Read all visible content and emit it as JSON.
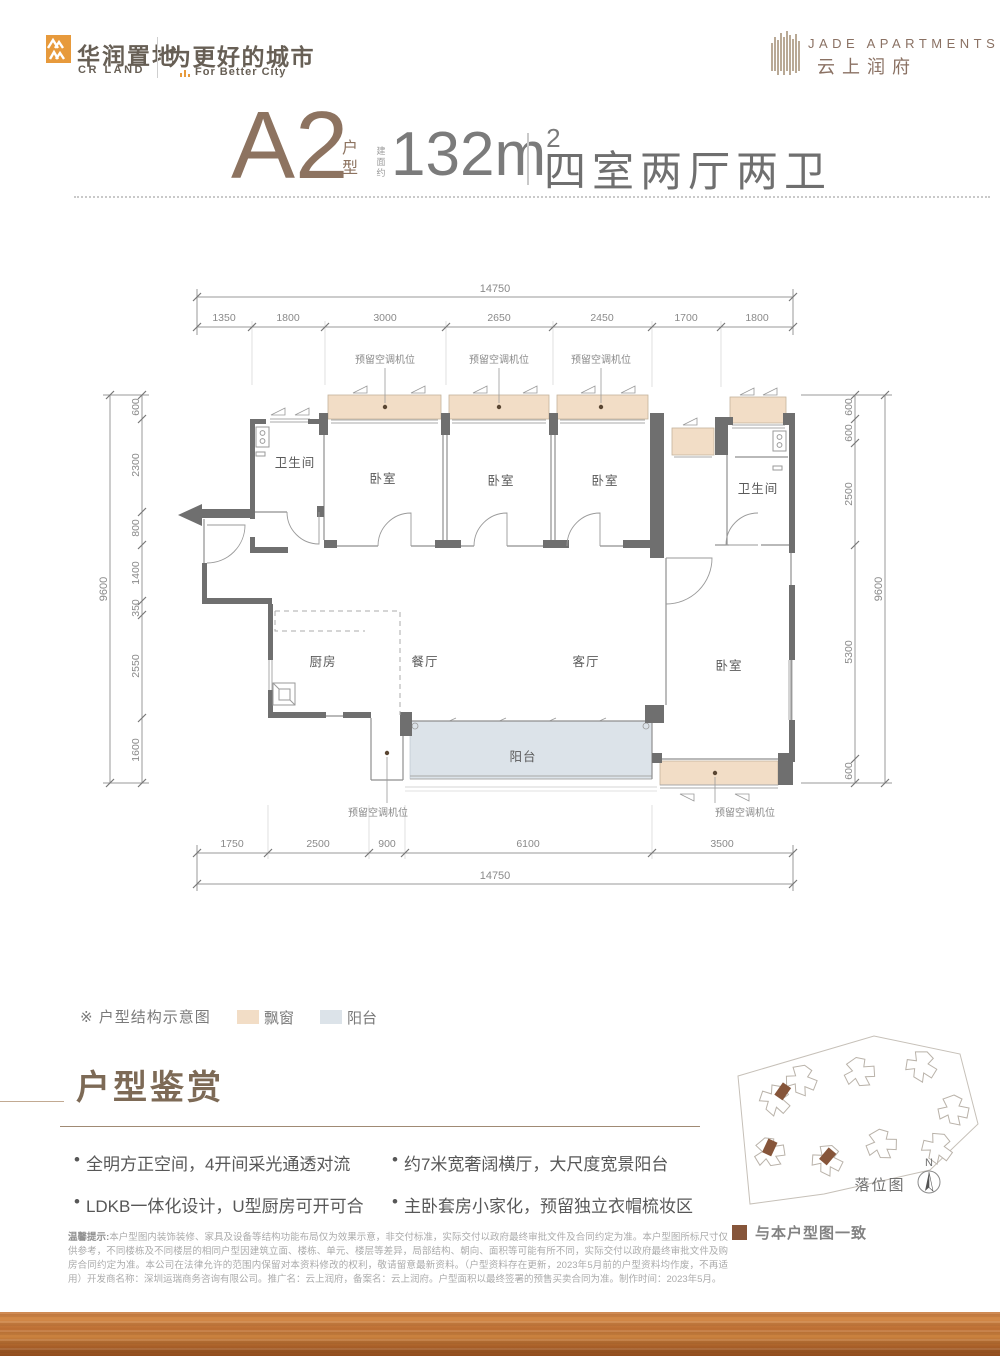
{
  "header": {
    "brand_cn": "华润置地",
    "brand_en": "CR LAND",
    "slogan_cn": "为更好的城市",
    "slogan_en": "For Better City",
    "project_en": "JADE APARTMENTS",
    "project_cn": "云上润府",
    "brand_orange": "#e79a3c",
    "brand_brown": "#8a7163"
  },
  "title": {
    "unit": "A2",
    "unit_suffix": "户型",
    "area_note": "建面约",
    "area": "132m",
    "area_sup": "2",
    "rooms": "四室两厅两卫"
  },
  "plan": {
    "rooms": {
      "bath": "卫生间",
      "bedroom": "卧室",
      "kitchen": "厨房",
      "dining": "餐厅",
      "living": "客厅",
      "balcony": "阳台"
    },
    "ac": "预留空调机位",
    "dims": {
      "top_total": "14750",
      "top": [
        "1350",
        "1800",
        "3000",
        "2650",
        "2450",
        "1700",
        "1800"
      ],
      "bottom": [
        "1750",
        "2500",
        "900",
        "6100",
        "3500"
      ],
      "bottom_total": "14750",
      "left": [
        "600",
        "2300",
        "800",
        "1400",
        "350",
        "2550",
        "1600"
      ],
      "left_total": "9600",
      "right": [
        "600",
        "600",
        "2500",
        "5300",
        "600"
      ],
      "right_total": "9600"
    },
    "colors": {
      "bay_window": "#f2ddc6",
      "balcony": "#dce3e9",
      "wall": "#6f6f6f"
    }
  },
  "legend": {
    "note": "※ 户型结构示意图",
    "item_bay": "飘窗",
    "item_balcony": "阳台"
  },
  "features": {
    "heading": "户型鉴赏",
    "left": [
      "全明方正空间，4开间采光通透对流",
      "LDKB一体化设计，U型厨房可开可合"
    ],
    "right": [
      "约7米宽奢阔横厅，大尺度宽景阳台",
      "主卧套房小家化，预留独立衣帽梳妆区"
    ],
    "bullet": "•"
  },
  "siteplan": {
    "title": "落位图",
    "north": "N",
    "match_note": "与本户型图一致",
    "highlight_color": "#86553a"
  },
  "disclaimer": {
    "label": "温馨提示:",
    "text": "本户型图内装饰装修、家具及设备等结构功能布局仅为效果示意，非交付标准，实际交付以政府最终审批文件及合同约定为准。本户型图所标尺寸仅供参考，不同楼栋及不同楼层的相同户型因建筑立面、楼栋、单元、楼层等差异，局部结构、朝向、面积等可能有所不同，实际交付以政府最终审批文件及购房合同约定为准。本公司在法律允许的范围内保留对本资料修改的权利，敬请留意最新资料。（户型资料存在更新，2023年5月前的户型资料均作废，不再适用）开发商名称：深圳运瑞商务咨询有限公司。推广名：云上润府，备案名：云上润府。户型面积以最终签署的预售买卖合同为准。制作时间：2023年5月。"
  }
}
